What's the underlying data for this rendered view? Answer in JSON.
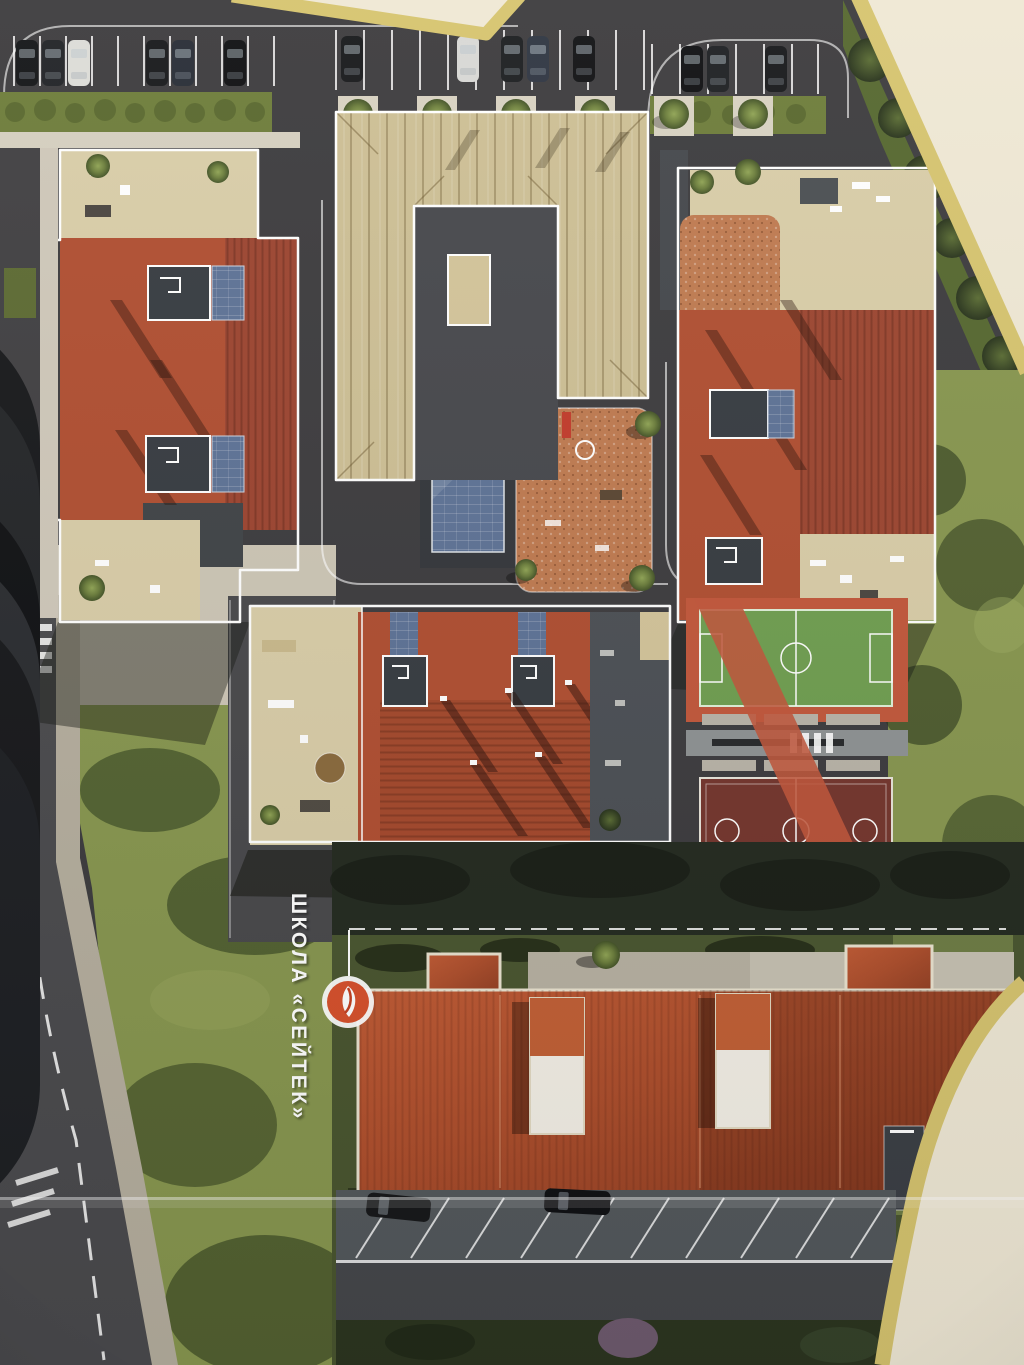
{
  "map": {
    "school_label": "ШКОЛА «СЕЙТЕК»",
    "logo": {
      "ring": "#ffffff",
      "fill": "#d6502b",
      "glyph": "#ffffff"
    }
  },
  "palette": {
    "page_cream": "#efe8d5",
    "fold_gold": "#d6c46f",
    "asphalt": "#3c3b3e",
    "roof_red": "#b04e31",
    "roof_school": "#ad4e2c",
    "roof_tan": "#cdbf95",
    "terrace_beige": "#d9cda8",
    "lawn": "#87964f",
    "dark_grass": "#49552f",
    "field_green": "#6f9e50",
    "court_maroon": "#74352d",
    "track_red": "#c2573b",
    "playground_orange": "#bf7a50",
    "glass_blue": "#5d7296",
    "outline_white": "#ffffff"
  }
}
